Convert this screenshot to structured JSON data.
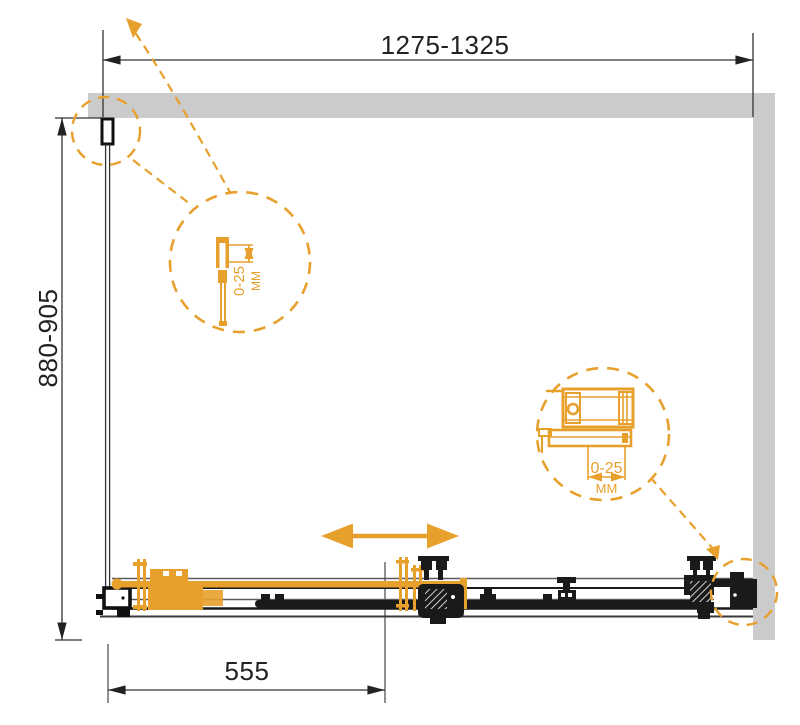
{
  "drawing": {
    "type": "shower-enclosure-plan-view",
    "dimensions": {
      "width_range": "1275-1325",
      "depth_range": "880-905",
      "door_width": "555"
    },
    "details": [
      {
        "value": "0-25",
        "unit": "ММ"
      },
      {
        "value": "0-25",
        "unit": "ММ"
      }
    ],
    "colors": {
      "accent_orange": "#E8A02C",
      "wall_gray": "#CBCBCB",
      "line_black": "#1A1A1A"
    }
  }
}
